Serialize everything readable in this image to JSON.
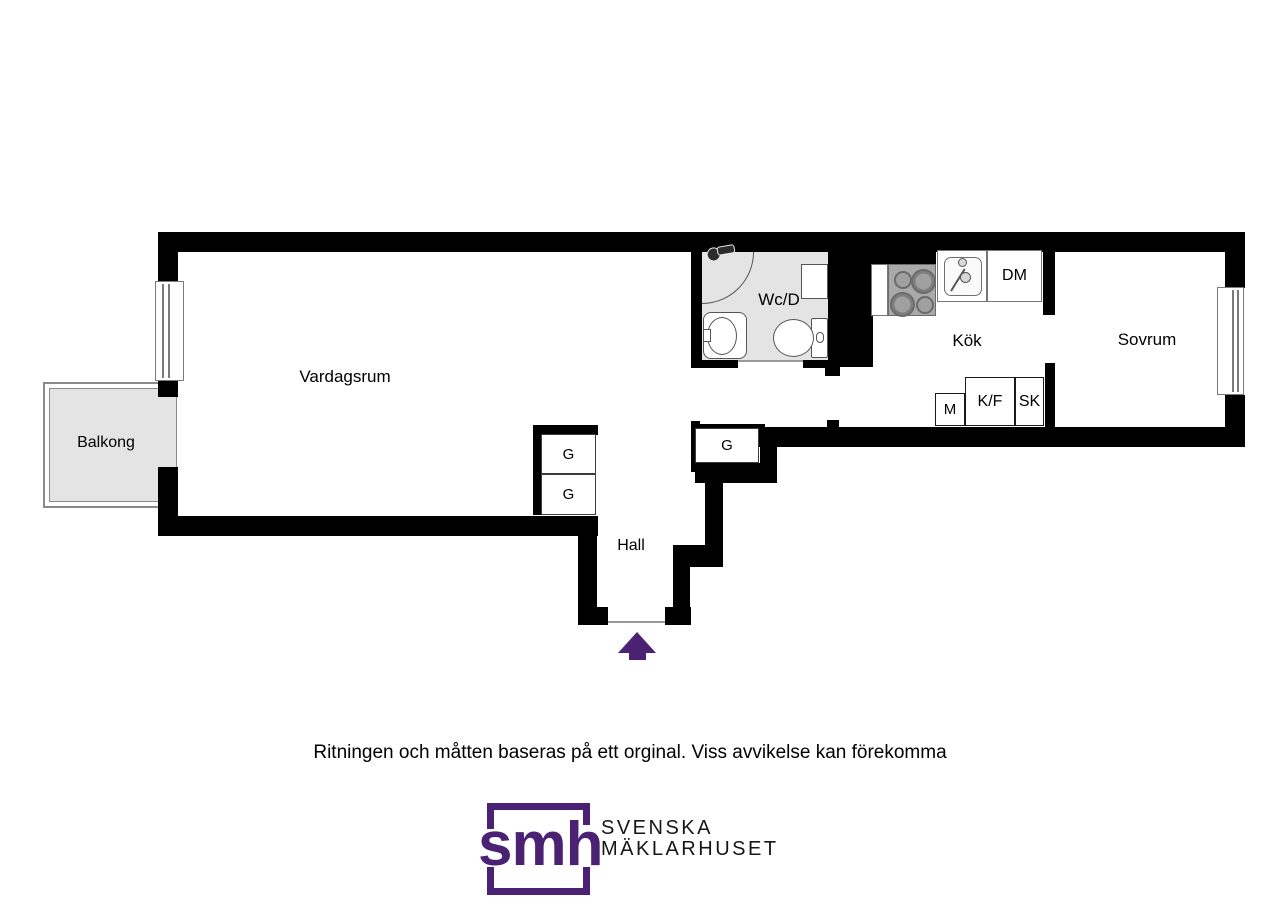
{
  "floorplan": {
    "rooms": {
      "vardagsrum": "Vardagsrum",
      "balkong": "Balkong",
      "wcd": "Wc/D",
      "kok": "Kök",
      "sovrum": "Sovrum",
      "hall": "Hall"
    },
    "storage": {
      "g_hall_left_top": "G",
      "g_hall_left_bottom": "G",
      "g_hall_right": "G",
      "dm": "DM",
      "m": "M",
      "kf": "K/F",
      "sk": "SK"
    }
  },
  "footer": {
    "disclaimer": "Ritningen och måtten baseras på ett orginal. Viss avvikelse kan förekomma",
    "logo": {
      "monogram": "smh",
      "company_line1": "SVENSKA",
      "company_line2": "MÄKLARHUSET"
    }
  },
  "colors": {
    "wall": "#000000",
    "brand_purple": "#4a2173",
    "floor_gray": "#e4e4e4"
  }
}
